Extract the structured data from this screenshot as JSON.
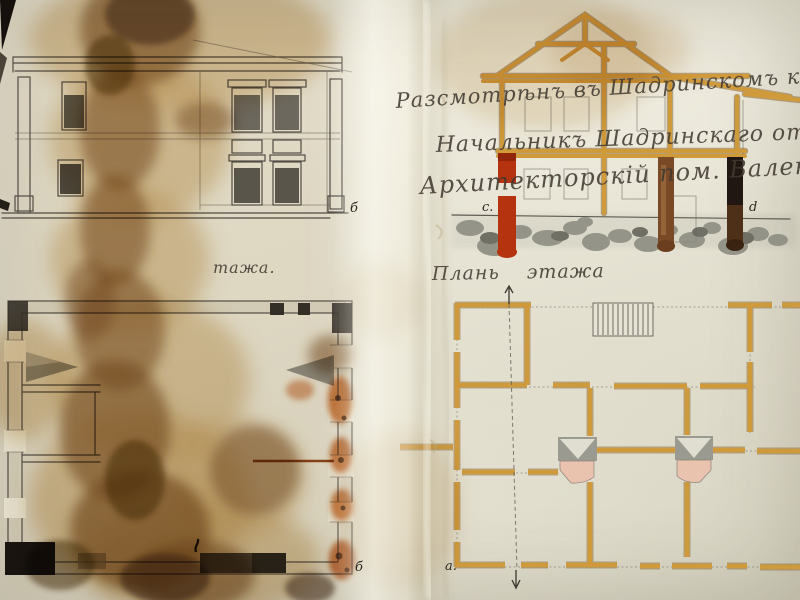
{
  "inscriptions": {
    "line1": "Разсмотрѣнъ въ Шадринскомъ ком. въ",
    "line2": "Начальникъ Шадринскаго отдѣл.,",
    "line3": "Архитекторскій пом.  Валенбергъ"
  },
  "captions": {
    "right_plan": "Плань  этажа",
    "left_plan_partial": "тажа."
  },
  "reference_letters": {
    "elevation_right": "б",
    "left_plan_corner": "б",
    "right_plan_corner": "а.",
    "section_left": "с.",
    "section_right": "d"
  },
  "colors": {
    "paper": "#e8e5d6",
    "stain_tan": "#c7a163",
    "stain_brown": "#7d4e1e",
    "stain_dark": "#45290c",
    "timber_ochre": "#d09a3a",
    "timber_shadow": "#7c5a22",
    "chimney_red": "#b5330f",
    "chimney_brown": "#7a4a26",
    "chimney_black": "#201712",
    "stone_gray": "#87877c",
    "pencil": "#55514a",
    "rust": "#c05a14",
    "stove_pink": "#e9c3ae"
  }
}
